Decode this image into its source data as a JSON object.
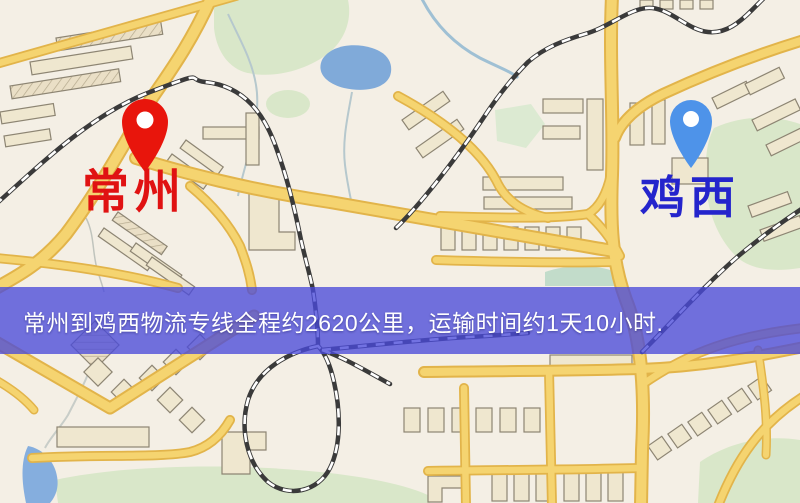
{
  "map": {
    "route_banner": {
      "text": "常州到鸡西物流专线全程约2620公里，运输时间约1天10小时.",
      "background_color": "rgba(74,74,218,0.78)",
      "text_color": "#ffffff"
    },
    "origin": {
      "label": "常州",
      "pin_color": "#e8150c",
      "label_color": "#e01212"
    },
    "destination": {
      "label": "鸡西",
      "pin_color": "#4e93e9",
      "label_color": "#2424cc"
    },
    "map_colors": {
      "land": "#f4efe5",
      "road_fill": "#f5d470",
      "road_edge": "#e2b44a",
      "park": "#d9e7c9",
      "water": "#80aad9",
      "building": "#efe7cf",
      "railway": "#3a3a3a"
    }
  }
}
